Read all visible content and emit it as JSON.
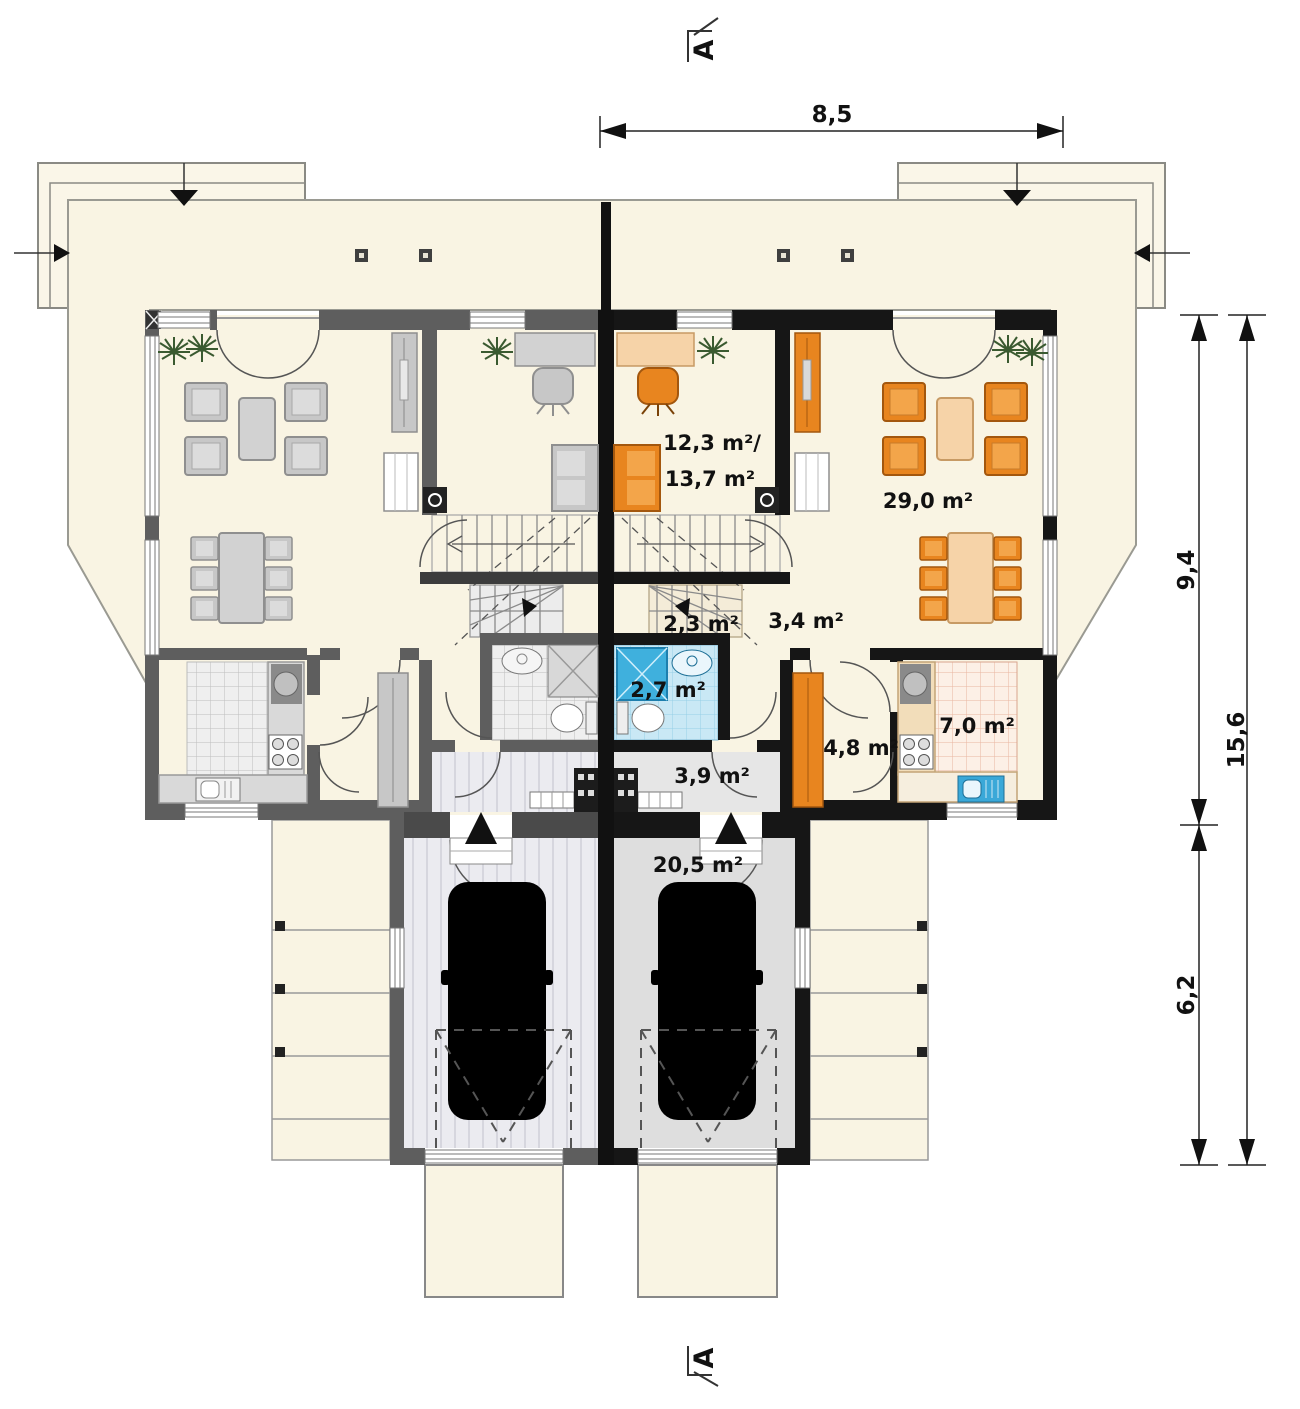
{
  "plan": {
    "section_markers": {
      "top": "A",
      "bottom": "A"
    },
    "dimensions": {
      "width_top": "8,5",
      "depth_main": "9,4",
      "depth_garage": "6,2",
      "depth_total": "15,6"
    },
    "rooms": {
      "office_area_line1": "12,3 m²/",
      "office_area_line2": "13,7 m²",
      "living_area": "29,0 m²",
      "stair_landing_area": "2,3 m²",
      "corridor_area": "3,4 m²",
      "bathroom_area": "2,7 m²",
      "vestibule_area": "3,9 m²",
      "hall_area": "4,8 m²",
      "kitchen_area": "7,0 m²",
      "garage_area": "20,5 m²"
    },
    "colors": {
      "left_unit_wall": "#5e5e5e",
      "right_unit_wall": "#161616",
      "floor_cream": "#f9f4e3",
      "furniture_orange": "#e8851f",
      "table_peach": "#f6d3a8",
      "bathroom_tile_blue": "#c9e8f5",
      "shower_blue": "#3fb0dd",
      "kitchen_tile_pink": "#fcf0e6",
      "car_green": "#8fc43c",
      "car_gray": "#c6c6c6",
      "plant_green": "#3a5a30"
    }
  }
}
